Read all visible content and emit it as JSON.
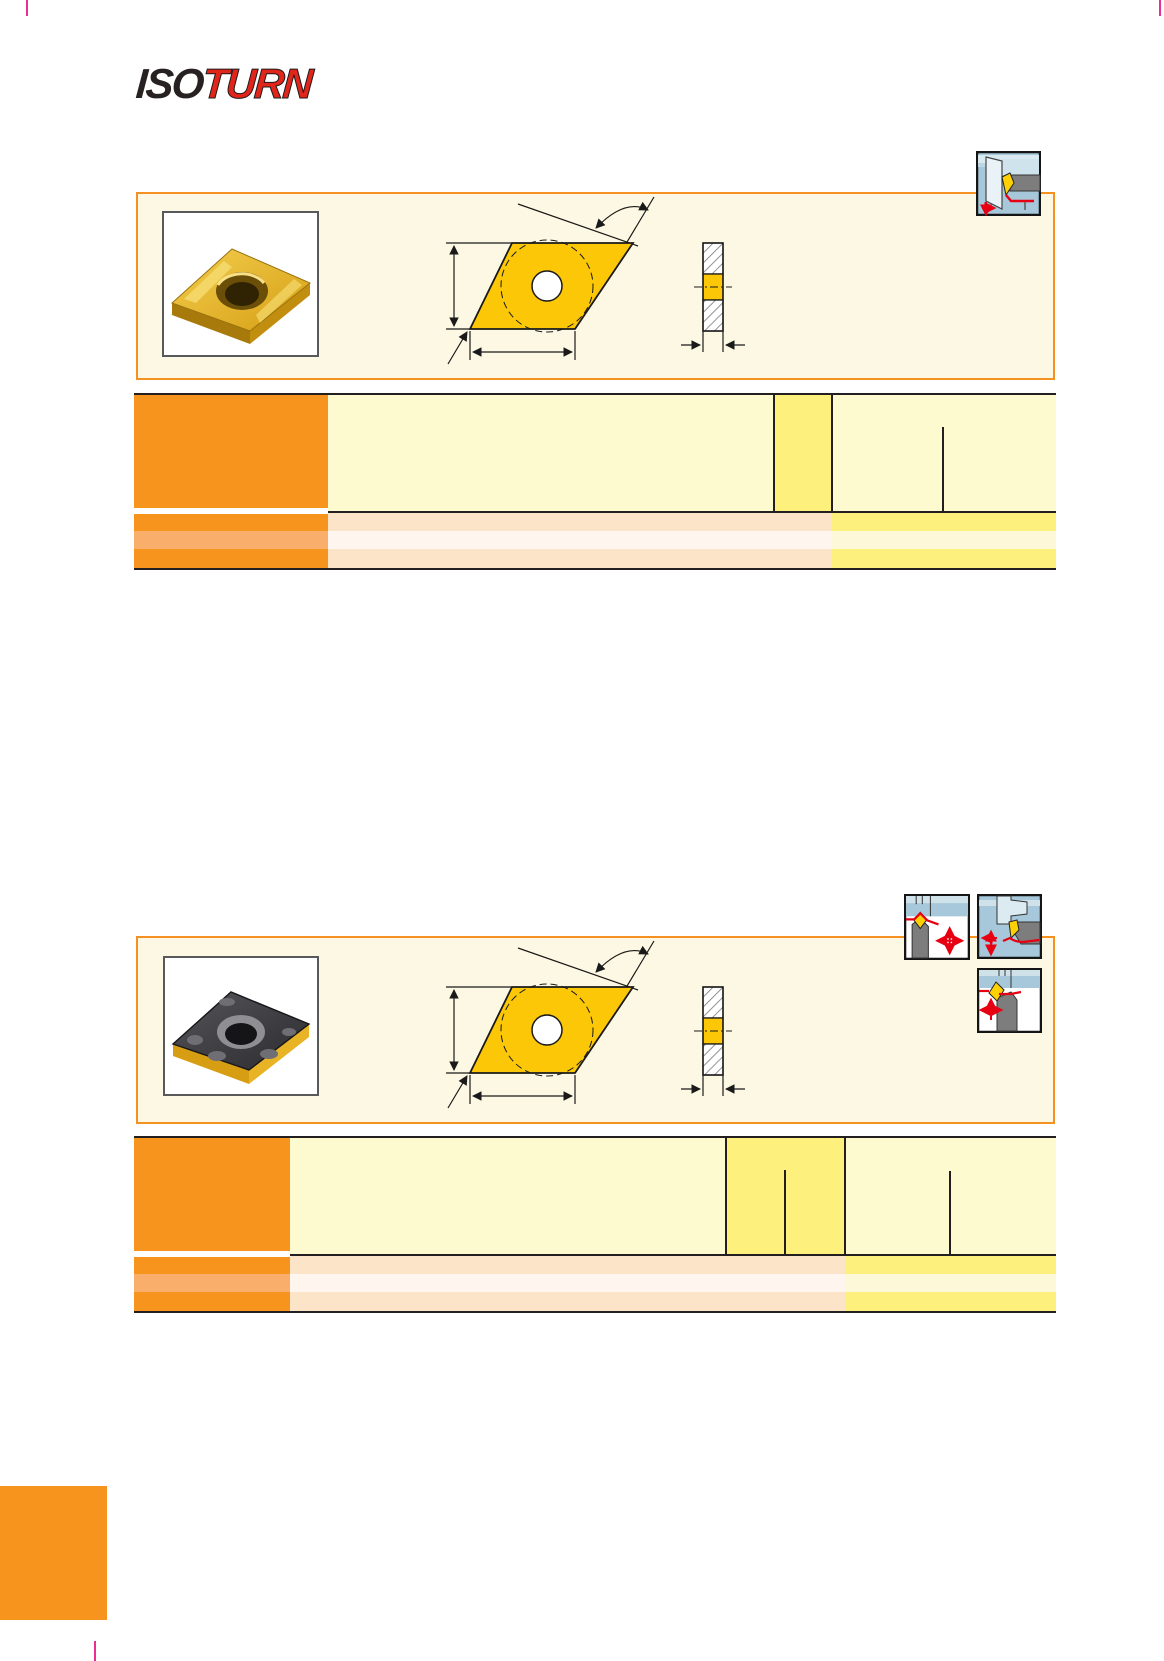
{
  "brand": {
    "iso": "ISO",
    "turn": "TURN"
  },
  "palette": {
    "orange": "#F7941E",
    "orange_light": "#FAAE6B",
    "panel_border": "#F59120",
    "panel_bg": "#FDF8E3",
    "pale_yellow": "#FDFACF",
    "pale_yellow_row": "#FCF8D8",
    "bright_yellow": "#FDF07D",
    "peach_row": "#FCE4C8",
    "white_row": "#FEF5EE",
    "line_black": "#231F20",
    "crop_pink": "#EC2D92",
    "logo_red": "#E1251B",
    "logo_black": "#272221"
  },
  "panels": [
    {
      "photo_subject": "gold coated 55-degree rhombic turning insert",
      "drawing_subject": "rhombic insert dimension drawing with side view",
      "icons": [
        "internal-boring-application-icon"
      ]
    },
    {
      "photo_subject": "black chipbreaker 55-degree rhombic turning insert",
      "drawing_subject": "rhombic insert dimension drawing with side view",
      "icons": [
        "profiling-application-icon",
        "external-turning-application-icon",
        "back-turning-application-icon"
      ]
    }
  ],
  "tables": [
    {
      "visible_text": "",
      "body_rows": 3
    },
    {
      "visible_text": "",
      "body_rows": 3
    }
  ]
}
